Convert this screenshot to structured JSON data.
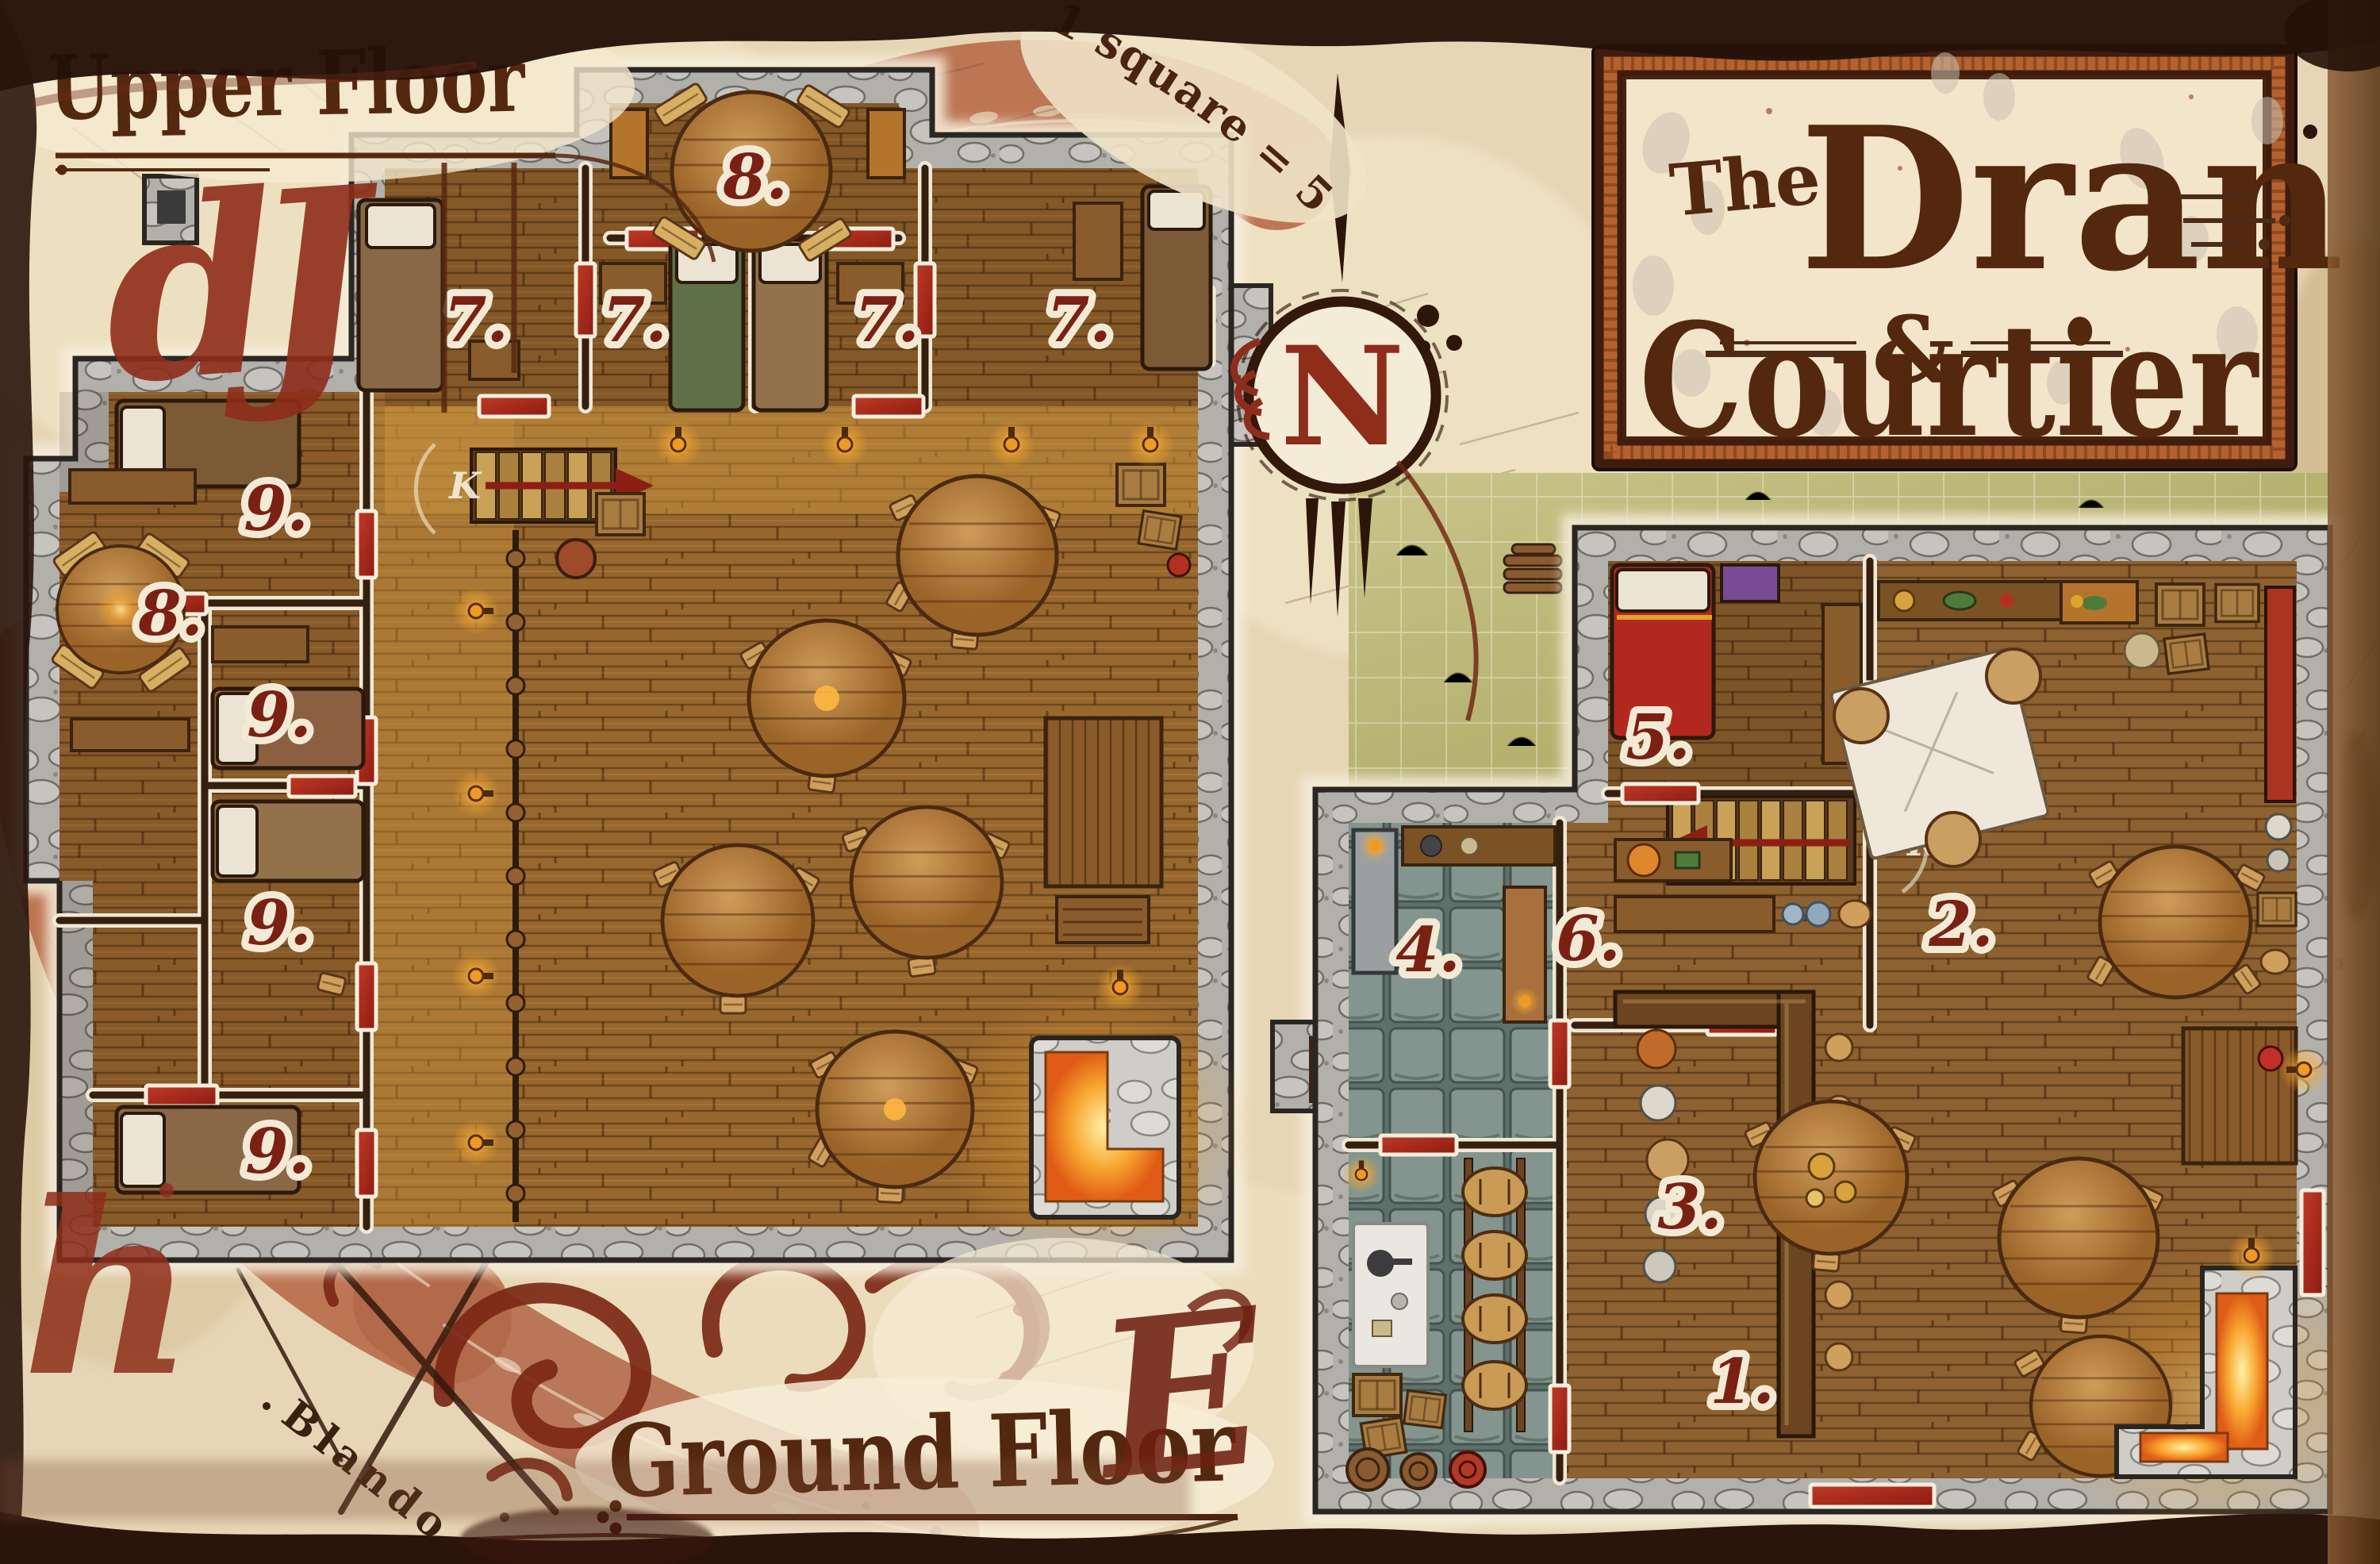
{
  "title_card": {
    "prefix": "The",
    "word1": "Dran",
    "ampersand": "&",
    "word2": "Courtier"
  },
  "labels": {
    "upper_floor": "Upper Floor",
    "ground_floor": "Ground Floor"
  },
  "scale_note": "1 square = 5 feet",
  "compass_letter": "N",
  "artist_signature": "Blando",
  "stair_rune": "K",
  "decorative_glyphs": {
    "top_left": "dJ",
    "bottom_left": "h",
    "ground_floor_flourish": "E"
  },
  "upper_floor": {
    "rooms": [
      {
        "id": "dining-room-top",
        "number": "8."
      },
      {
        "id": "guest-room-a",
        "number": "7."
      },
      {
        "id": "guest-room-b",
        "number": "7."
      },
      {
        "id": "guest-room-c",
        "number": "7."
      },
      {
        "id": "guest-room-d",
        "number": "7."
      },
      {
        "id": "bunk-room-a",
        "number": "9."
      },
      {
        "id": "bunk-room-b",
        "number": "9."
      },
      {
        "id": "bunk-room-c",
        "number": "9."
      },
      {
        "id": "bunk-room-d",
        "number": "9."
      },
      {
        "id": "lounge-left",
        "number": "8."
      }
    ]
  },
  "ground_floor": {
    "rooms": [
      {
        "id": "common-room-main",
        "number": "1."
      },
      {
        "id": "common-room-north",
        "number": "2."
      },
      {
        "id": "bar",
        "number": "3."
      },
      {
        "id": "kitchen",
        "number": "4."
      },
      {
        "id": "bedroom",
        "number": "5."
      },
      {
        "id": "stair-hall",
        "number": "6."
      }
    ]
  },
  "colors": {
    "parchment": "#e6d6b5",
    "rust_band": "#b76c49",
    "maroon_ink": "#7b2818",
    "red_glyph": "#8e2d1a",
    "stone_wall": "#b3b1ac",
    "wood_floor": "#97672e",
    "door_red": "#b02a1c",
    "grass": "#b9b46f",
    "fire_glow": "#f5a623",
    "card_cream": "#f2e5c9",
    "dark_border": "#241108"
  }
}
